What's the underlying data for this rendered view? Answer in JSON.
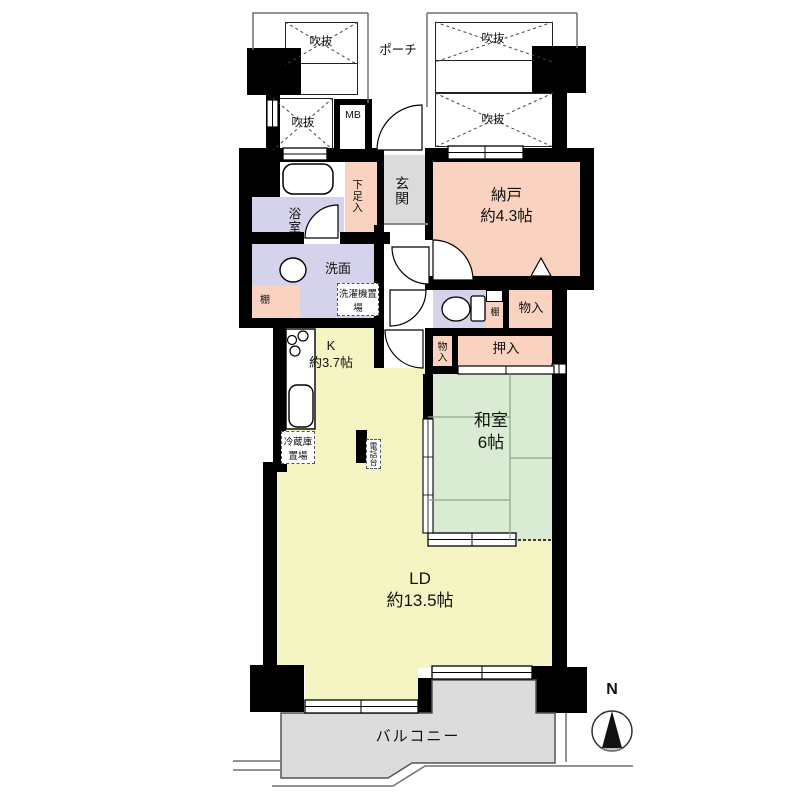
{
  "plan": {
    "title": "マンション間取り図",
    "porch_label": "ポーチ",
    "void_label": "吹抜",
    "meter_box_label": "MB",
    "entrance_label": "玄関",
    "shoe_cabinet_label": "下足入",
    "bathroom_label": "浴室",
    "washroom_label": "洗面",
    "washer_space_label": "洗濯機置場",
    "shelf_label": "棚",
    "storage_room": {
      "name": "納戸",
      "size": "約4.3帖"
    },
    "closet_label": "物入",
    "oshiire_label": "押入",
    "kitchen": {
      "name": "K",
      "size": "約3.7帖"
    },
    "japanese_room": {
      "name": "和室",
      "size": "6帖"
    },
    "living_dining": {
      "name": "LD",
      "size": "約13.5帖"
    },
    "fridge_space_label": "冷蔵庫置場",
    "phone_stand_label": "電話台",
    "balcony_label": "バルコニー",
    "compass_north_label": "N",
    "colors": {
      "service_rooms": "#F9D3BF",
      "wet_rooms": "#D5D3EB",
      "entry": "#DBDBDB",
      "living_kitchen": "#F5F5C4",
      "tatami_room": "#D9ECD3",
      "balcony": "#DCDCDC",
      "walls": "#000000"
    }
  }
}
